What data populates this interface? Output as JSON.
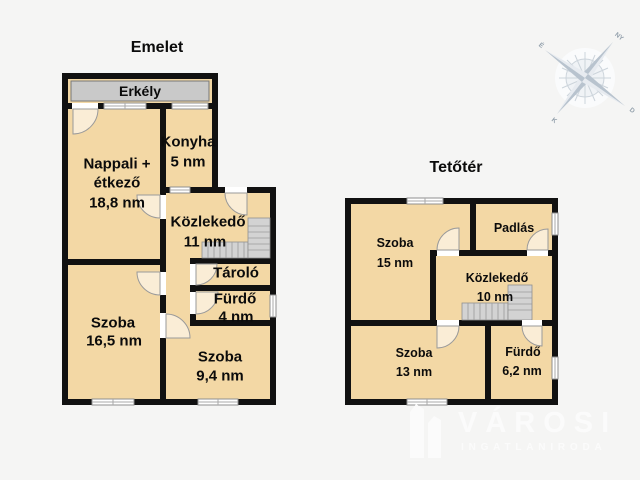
{
  "floorplan": {
    "emelet": {
      "title": "Emelet",
      "balcony": "Erkély",
      "rooms": {
        "nappali": {
          "lines": [
            "Nappali +",
            "étkező",
            "18,8 nm"
          ]
        },
        "konyha": {
          "lines": [
            "Konyha",
            "5 nm"
          ]
        },
        "kozlekedo": {
          "lines": [
            "Közlekedő",
            "11 nm"
          ]
        },
        "tarolo": {
          "lines": [
            "Tároló"
          ]
        },
        "furdo": {
          "lines": [
            "Fürdő",
            "4 nm"
          ]
        },
        "szoba_nagy": {
          "lines": [
            "Szoba",
            "16,5 nm"
          ]
        },
        "szoba_kis": {
          "lines": [
            "Szoba",
            "9,4 nm"
          ]
        }
      }
    },
    "tetoter": {
      "title": "Tetőtér",
      "rooms": {
        "szoba15": {
          "lines": [
            "Szoba",
            "15 nm"
          ]
        },
        "padlas": {
          "lines": [
            "Padlás"
          ]
        },
        "kozlekedo": {
          "lines": [
            "Közlekedő",
            "10 nm"
          ]
        },
        "szoba13": {
          "lines": [
            "Szoba",
            "13 nm"
          ]
        },
        "furdo": {
          "lines": [
            "Fürdő",
            "6,2 nm"
          ]
        }
      }
    }
  },
  "compass": {
    "labels": {
      "nw": "É",
      "ne": "NY",
      "sw": "K",
      "se": "D"
    }
  },
  "brand": {
    "name": "VÁROSI",
    "subtitle": "INGATLANIRODA"
  },
  "colors": {
    "background": "#f5f5f4",
    "room_fill": "#f3d8a5",
    "wall": "#111111",
    "balcony_fill": "#c9c9c9",
    "stair_fill": "#d3d3d3",
    "window_stroke": "#8f8f8f",
    "logo": "#fbfbfb"
  }
}
